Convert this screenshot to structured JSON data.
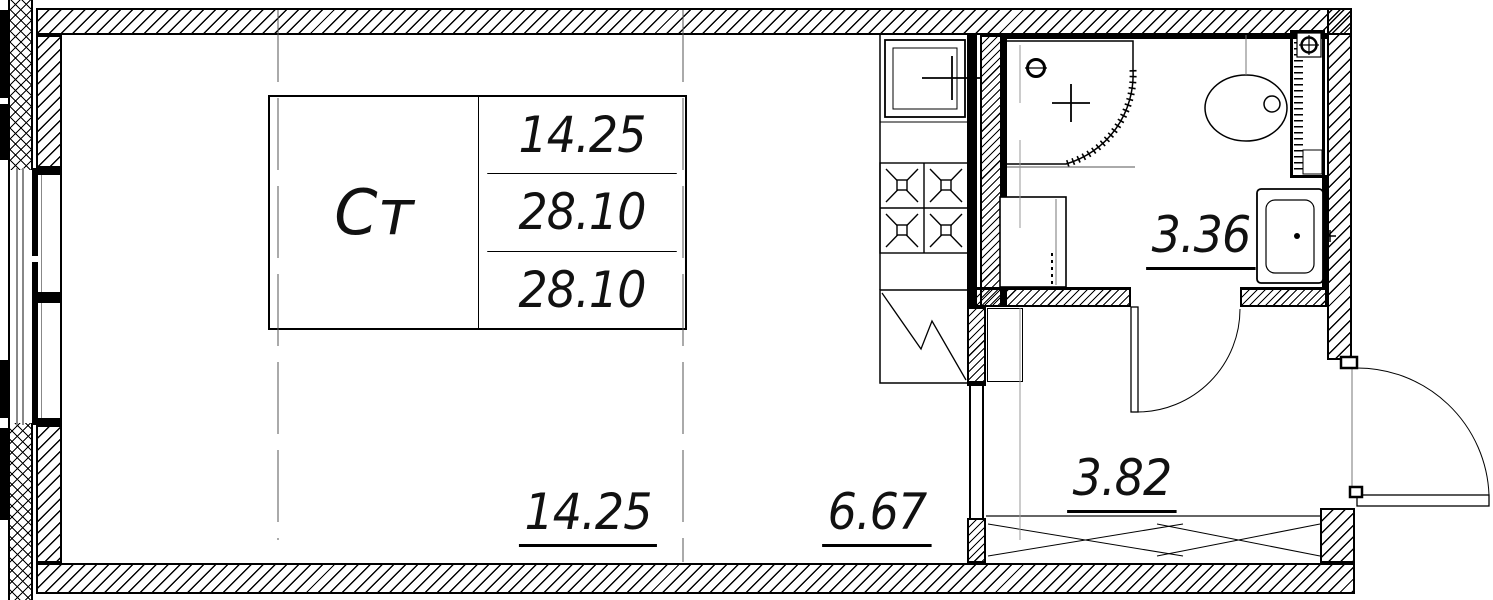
{
  "plan": {
    "room_stamp": {
      "room_type_label": "Ст",
      "rows": [
        "14.25",
        "28.10",
        "28.10"
      ]
    },
    "area_labels": {
      "living": "14.25",
      "kitchen": "6.67",
      "hallway": "3.82",
      "bathroom": "3.36"
    },
    "fixtures": [
      "kitchen-sink",
      "stove-4-burners",
      "fridge",
      "shower-tray",
      "floor-drain",
      "washing-machine",
      "toilet",
      "bathroom-sink",
      "vent-duct",
      "wardrobe-sliding-doors",
      "bathroom-door",
      "entrance-door",
      "window"
    ],
    "colors": {
      "line": "#000000",
      "secondary_line": "#808080",
      "background": "#ffffff"
    }
  }
}
